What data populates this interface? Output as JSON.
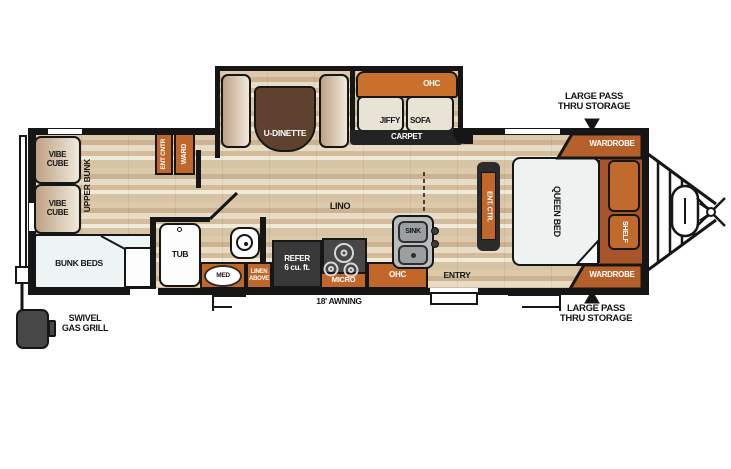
{
  "labels": {
    "vibe_cube_top": "VIBE\nCUBE",
    "vibe_cube_bottom": "VIBE\nCUBE",
    "upper_bunk": "UPPER BUNK",
    "bunk_beds": "BUNK BEDS",
    "ent_cntr": "ENT CNTR",
    "ward": "WARD",
    "u_dinette": "U-DINETTE",
    "sofa_ohc": "OHC",
    "jiffy": "JIFFY",
    "sofa": "SOFA",
    "carpet": "CARPET",
    "tub": "TUB",
    "med": "MED",
    "linen_above": "LINEN\nABOVE",
    "refer": "REFER\n6 cu. ft.",
    "micro": "MICRO",
    "kitchen_ohc": "OHC",
    "sink": "SINK",
    "lino": "LINO",
    "entry": "ENTRY",
    "awning": "18' AWNING",
    "ent_ctr": "ENT. CTR.",
    "queen_bed": "QUEEN BED",
    "shelf": "SHELF",
    "wardrobe_top": "WARDROBE",
    "wardrobe_bottom": "WARDROBE",
    "storage_top": "LARGE PASS\nTHRU STORAGE",
    "storage_bottom": "LARGE PASS\nTHRU STORAGE",
    "grill": "SWIVEL\nGAS GRILL"
  },
  "colors": {
    "accent_orange": "#c2672a",
    "storage_brown": "#a9552a",
    "wall_black": "#161616",
    "carpet_dark": "#232323",
    "floor_base": "#d8c5a6",
    "appliance_dark": "#3f3f3f"
  }
}
